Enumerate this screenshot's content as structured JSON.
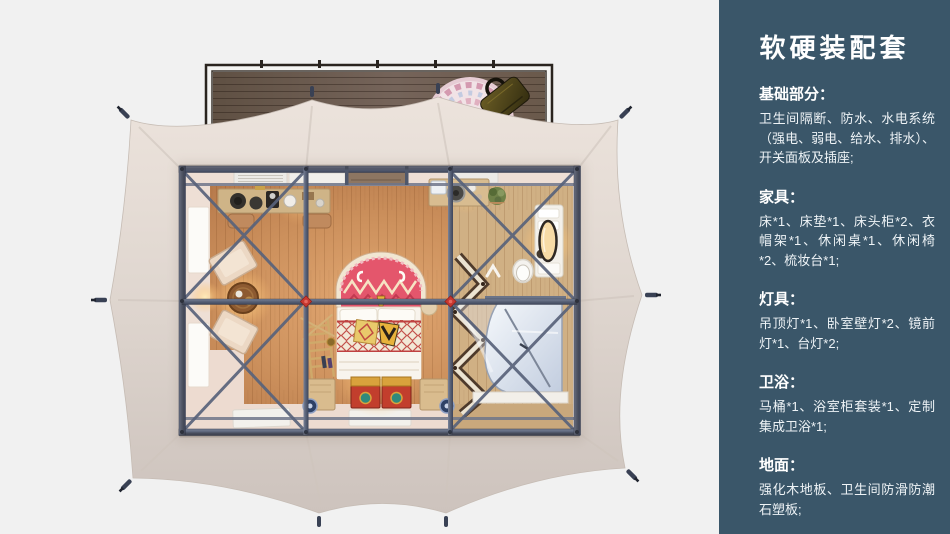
{
  "panel": {
    "bg_color": "#3a5669",
    "text_color": "#ffffff",
    "title": "软硬装配套",
    "sections": [
      {
        "id": "basics",
        "header": "基础部分：",
        "body": "卫生间隔断、防水、水电系统（强电、弱电、给水、排水）、开关面板及插座;"
      },
      {
        "id": "furniture",
        "header": "家具：",
        "body": "床*1、床垫*1、床头柜*2、衣帽架*1、休闲桌*1、休闲椅*2、梳妆台*1;"
      },
      {
        "id": "lighting",
        "header": "灯具：",
        "body": "吊顶灯*1、卧室壁灯*2、镜前灯*1、台灯*2;"
      },
      {
        "id": "bathroom",
        "header": "卫浴：",
        "body": "马桶*1、浴室柜套装*1、定制集成卫浴*1;"
      },
      {
        "id": "flooring",
        "header": "地面：",
        "body": "强化木地板、卫生间防滑防潮石塑板;"
      }
    ]
  },
  "scene": {
    "colors": {
      "background": "#f1f1f1",
      "canopy": "#ddd4cd",
      "deck_wood": "#6e5d4f",
      "floor_wood": "#c98f5e",
      "frame_steel": "#525b70",
      "accent_red": "#c8372f",
      "bath_pod": "#dbe3ef"
    },
    "elements": [
      "wooden-deck",
      "deck-round-rug",
      "tote-bag",
      "tent-canopy",
      "guy-line-hooks",
      "steel-frame",
      "bedroom-wood-floor",
      "arched-ethnic-rug",
      "double-bed",
      "pattern-cushions",
      "storage-chests",
      "drum-side-tables",
      "decor-ladder",
      "lounge-chairs",
      "tea-table",
      "hat-rack-desk",
      "stools",
      "coffee-counter",
      "potted-plant",
      "vanity-counter",
      "oval-mirror",
      "toilet",
      "zigzag-wardrobe",
      "integrated-bathroom-pod",
      "partition-wall",
      "air-vents",
      "windows",
      "door-mats"
    ]
  }
}
